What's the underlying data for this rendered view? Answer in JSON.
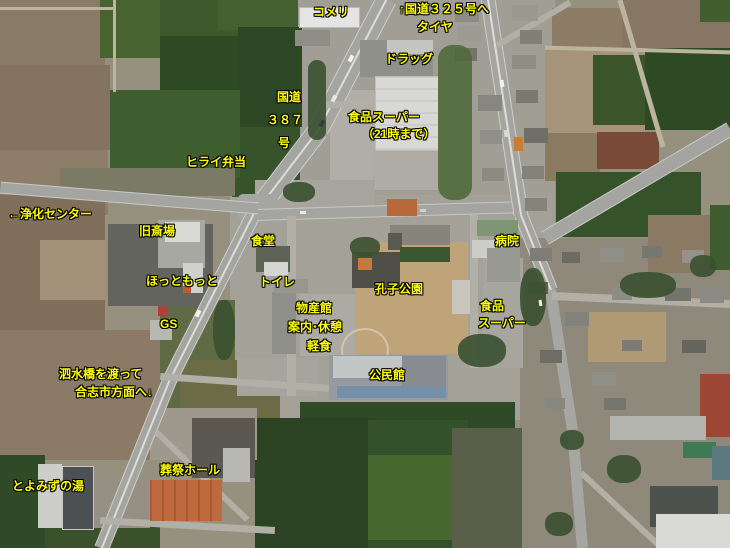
{
  "map": {
    "kind": "annotated aerial photo",
    "labels": {
      "komeri": "コメリ",
      "route325": "↑国道３２５号へ",
      "tire": "タイヤ",
      "drug": "ドラッグ",
      "route387_line1": "国道",
      "route387_line2": "３８７",
      "route387_line3": "号",
      "super_center_line1": "食品スーパー",
      "super_center_line2": "（21時まで）",
      "hirai_bento": "ヒライ弁当",
      "jouka_center": "←浄化センター",
      "kyu_saijo": "旧斎場",
      "shokudo": "食堂",
      "hotto_motto": "ほっともっと",
      "toilet": "トイレ",
      "gs": "GS",
      "bussankan": "物産館",
      "annai_kyukei": "案内･休憩",
      "keishoku": "軽食",
      "koshi_park": "孔子公園",
      "kominkan": "公民館",
      "byoin": "病院",
      "super_right_line1": "食品",
      "super_right_line2": "スーパー",
      "shisui_line1": "泗水橋を渡って",
      "shisui_line2": "合志市方面へ↓",
      "sosai_hall": "葬祭ホール",
      "toyomizu_yu": "とよみずの湯"
    },
    "colors": {
      "label_text": "#ffff00",
      "label_outline": "#000000",
      "funeral_hall_roof_orange": "#bf6a3e",
      "red_building": "#9c4636",
      "supermarket_roof_white": "#d8d8d6",
      "park_ground_tan": "#bfa379",
      "field_green_dark": "#2c4723",
      "field_brown": "#8a7a66",
      "road_gray": "#a4a4a0"
    }
  }
}
